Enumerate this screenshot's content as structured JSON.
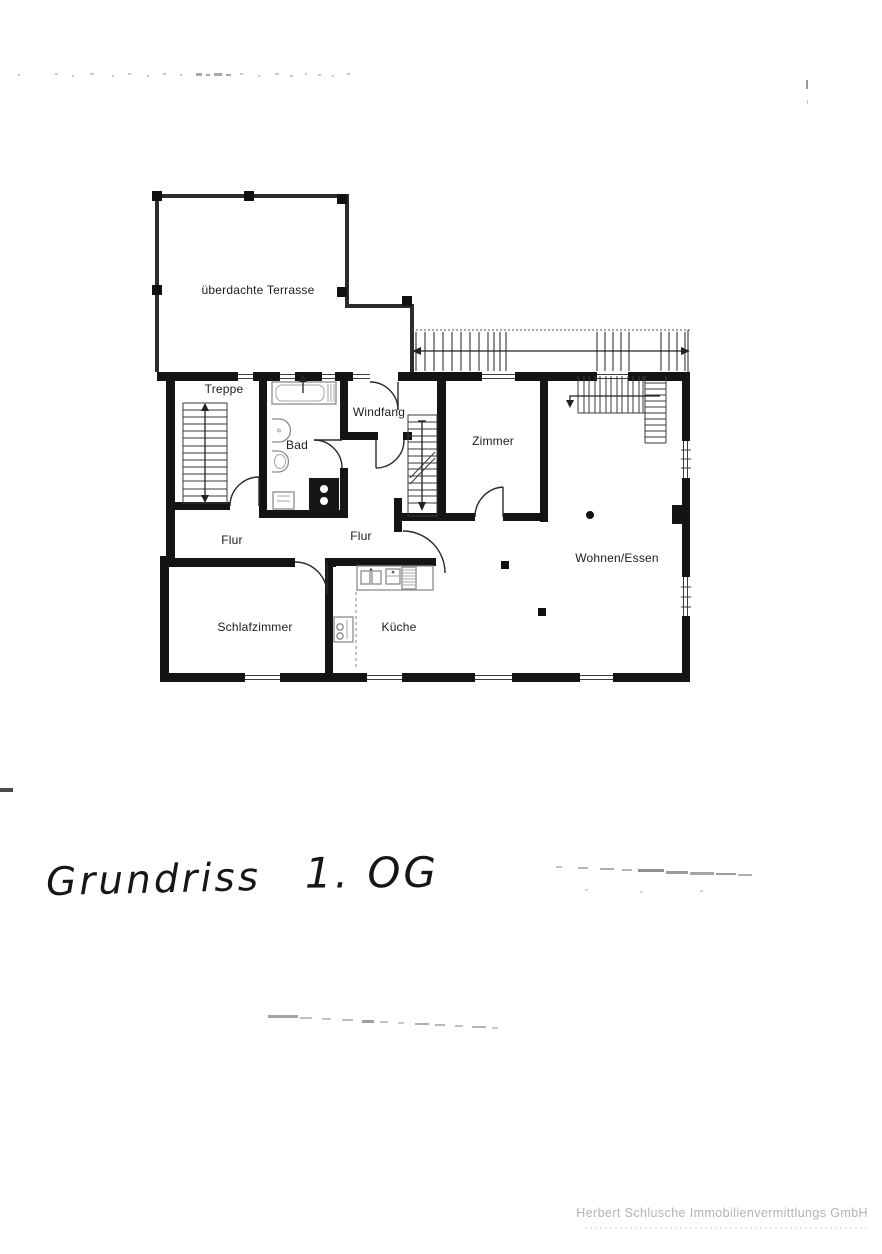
{
  "floor_plan": {
    "room_labels": {
      "terrasse": "überdachte Terrasse",
      "treppe": "Treppe",
      "bad": "Bad",
      "windfang": "Windfang",
      "zimmer": "Zimmer",
      "flur_left": "Flur",
      "flur_middle": "Flur",
      "wohnen_essen": "Wohnen/Essen",
      "schlafzimmer": "Schlafzimmer",
      "kueche": "Küche"
    }
  },
  "handwriting": {
    "title": "Grundriss 1. OG",
    "word1": "Grundriss",
    "word2": "1. OG"
  },
  "footer": {
    "company": "Herbert Schlusche Immobilienvermittlungs GmbH"
  },
  "colors": {
    "paper": "#ffffff",
    "wall": "#141414",
    "ink": "#1c1c1c",
    "fixture": "#8c8c8c",
    "footer_text": "#b6b3af"
  }
}
